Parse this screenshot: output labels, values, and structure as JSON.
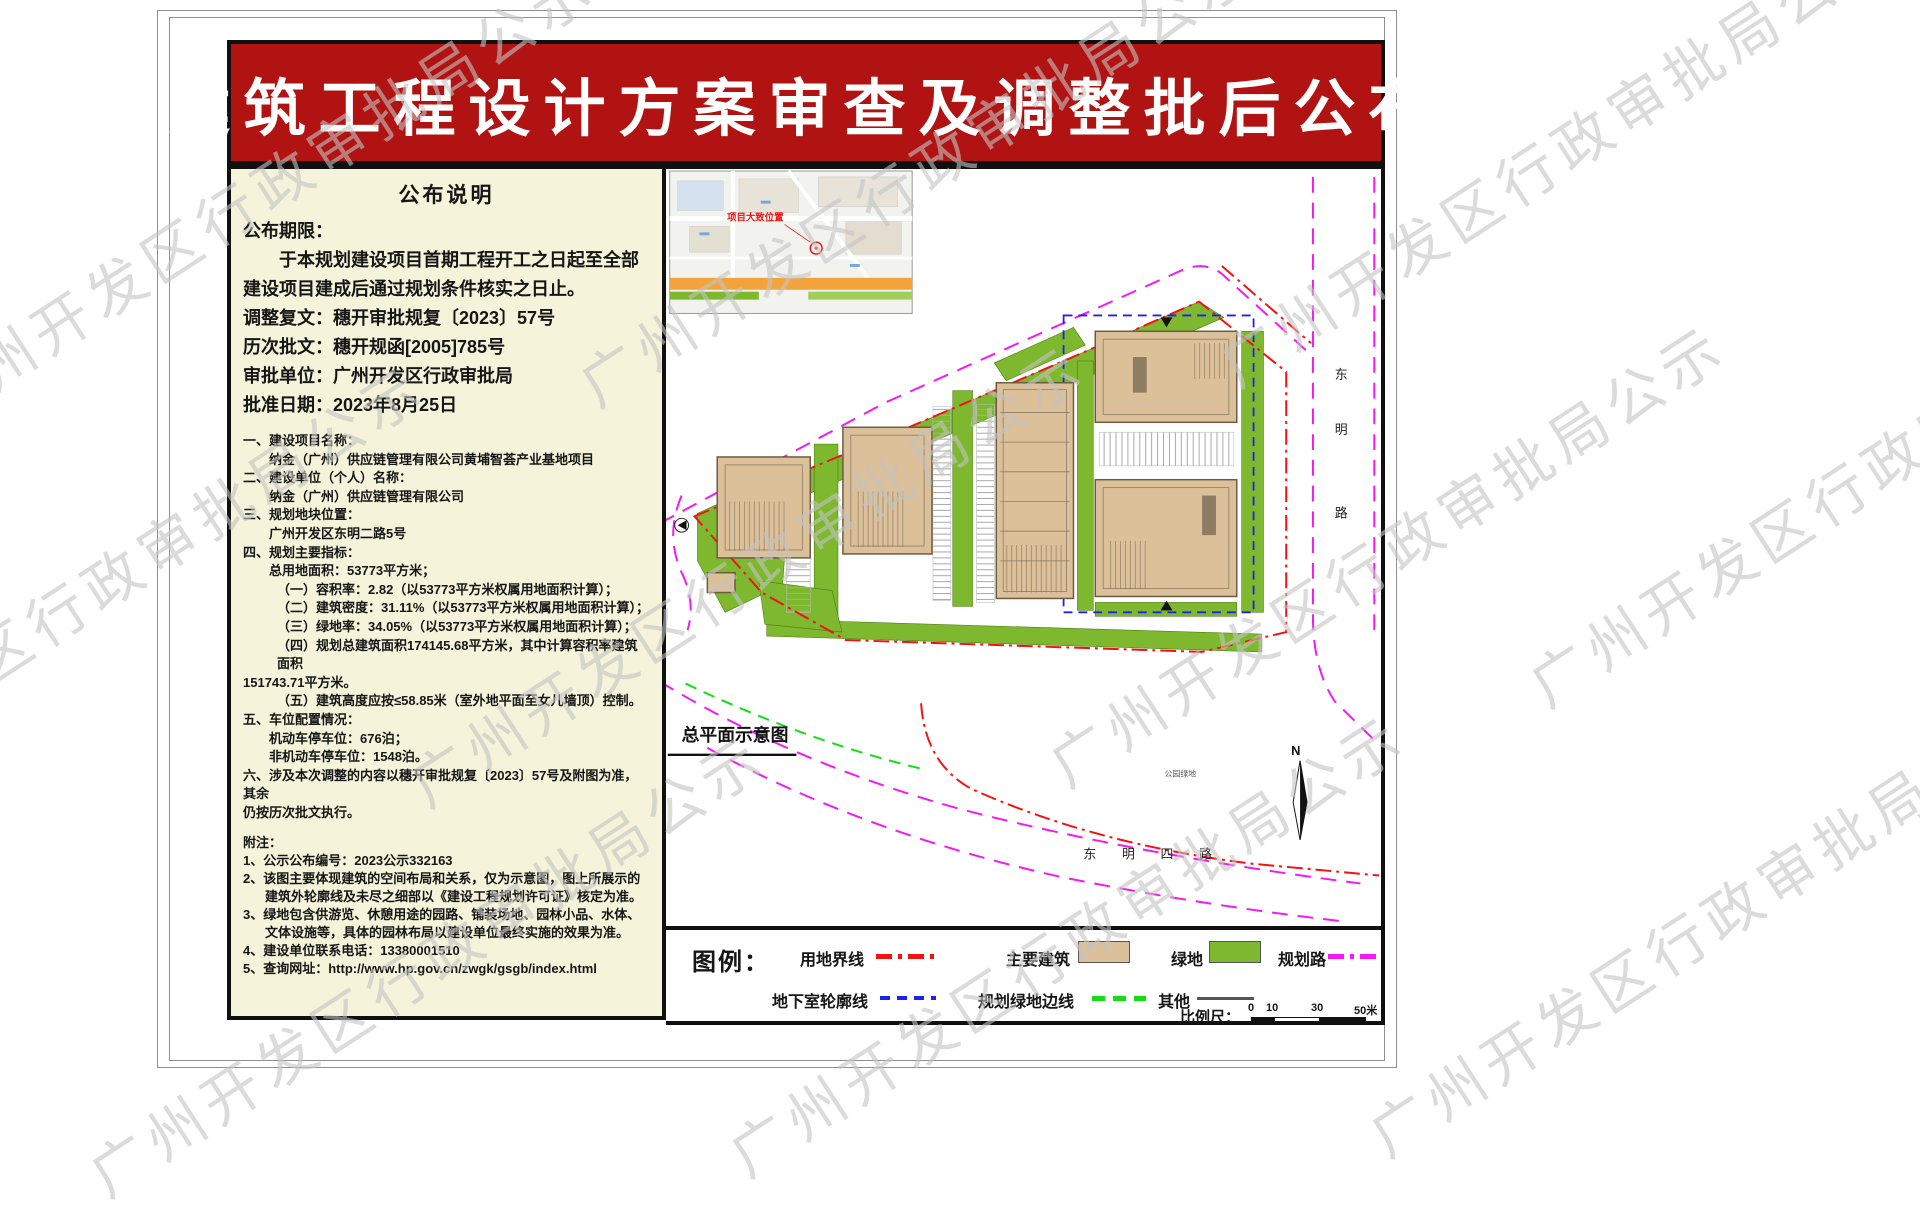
{
  "watermark": {
    "text": "广州开发区行政审批局公示"
  },
  "banner": {
    "title": "建筑工程设计方案审查及调整批后公布",
    "bg_color": "#b01311"
  },
  "notice": {
    "title": "公布说明",
    "period_label": "公布期限：",
    "period_text": "于本规划建设项目首期工程开工之日起至全部建设项目建成后通过规划条件核实之日止。",
    "lines": [
      "调整复文：穗开审批规复〔2023〕57号",
      "历次批文：穗开规函[2005]785号",
      "审批单位：广州开发区行政审批局",
      "批准日期：2023年8月25日"
    ],
    "items": [
      {
        "t": "一、建设项目名称："
      },
      {
        "t": "纳金（广州）供应链管理有限公司黄埔智荟产业基地项目"
      },
      {
        "t": "二、建设单位（个人）名称："
      },
      {
        "t": "纳金（广州）供应链管理有限公司"
      },
      {
        "t": "三、规划地块位置："
      },
      {
        "t": "广州开发区东明二路5号"
      },
      {
        "t": "四、规划主要指标："
      },
      {
        "t": "总用地面积：53773平方米；"
      },
      {
        "t": "（一）容积率：2.82（以53773平方米权属用地面积计算）；"
      },
      {
        "t": "（二）建筑密度：31.11%（以53773平方米权属用地面积计算）；"
      },
      {
        "t": "（三）绿地率：34.05%（以53773平方米权属用地面积计算）；"
      },
      {
        "t": "（四）规划总建筑面积174145.68平方米，其中计算容积率建筑面积"
      },
      {
        "t": "151743.71平方米。"
      },
      {
        "t": "（五）建筑高度应按≤58.85米（室外地平面至女儿墙顶）控制。"
      },
      {
        "t": "五、车位配置情况："
      },
      {
        "t": "机动车停车位：676泊；"
      },
      {
        "t": "非机动车停车位：1548泊。"
      },
      {
        "t": "六、涉及本次调整的内容以穗开审批规复〔2023〕57号及附图为准，其余"
      },
      {
        "t": "仍按历次批文执行。"
      }
    ],
    "notes_label": "附注：",
    "notes": [
      "1、公示公布编号：2023公示332163",
      "2、该图主要体现建筑的空间布局和关系，仅为示意图，图上所展示的建筑外轮廓线及未尽之细部以《建设工程规划许可证》核定为准。",
      "3、绿地包含供游览、休憩用途的园路、铺装场地、园林小品、水体、文体设施等，具体的园林布局以建设单位最终实施的效果为准。",
      "4、建设单位联系电话：13380001510",
      "5、查询网址：http://www.hp.gov.cn/zwgk/gsgb/index.html"
    ]
  },
  "plan": {
    "caption": "总平面示意图",
    "map_label": "项目大致位置",
    "road_bottom": "东明四路",
    "road_right_chars": [
      "东",
      "明",
      "路"
    ],
    "park_label": "公园绿地",
    "north": "N"
  },
  "legend": {
    "title": "图例：",
    "items": [
      {
        "label": "用地界线",
        "color": "#f31212",
        "style": "dashdot"
      },
      {
        "label": "主要建筑",
        "color": "#dcc09a",
        "style": "fill"
      },
      {
        "label": "绿地",
        "color": "#7db82e",
        "style": "fill"
      },
      {
        "label": "规划路",
        "color": "#f517f5",
        "style": "dashdot"
      },
      {
        "label": "地下室轮廓线",
        "color": "#2020f0",
        "style": "dashed"
      },
      {
        "label": "规划绿地边线",
        "color": "#15dd15",
        "style": "dashed"
      },
      {
        "label": "其他",
        "color": "#555555",
        "style": "solid"
      }
    ]
  },
  "scale": {
    "label": "比例尺：",
    "ticks": [
      "0",
      "10",
      "30",
      "50米"
    ]
  }
}
